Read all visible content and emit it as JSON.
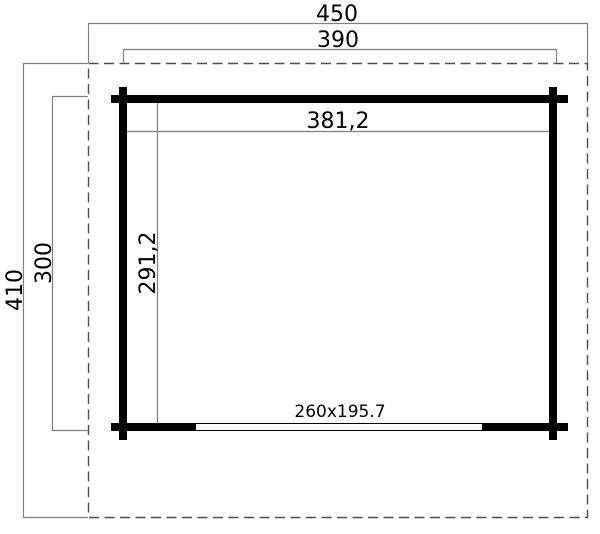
{
  "drawing": {
    "title": "garden-house-floor-plan",
    "labels": {
      "total_width": "450",
      "building_width": "390",
      "interior_width": "381,2",
      "total_depth": "410",
      "building_depth": "300",
      "interior_depth": "291,2",
      "door_size": "260x195.7"
    },
    "colors": {
      "wall": "#000000",
      "dimension_line": "#808080",
      "overhang_dash": "#4d4d4d",
      "background": "#ffffff",
      "door_fill": "#ffffff",
      "text": "#000000"
    }
  }
}
